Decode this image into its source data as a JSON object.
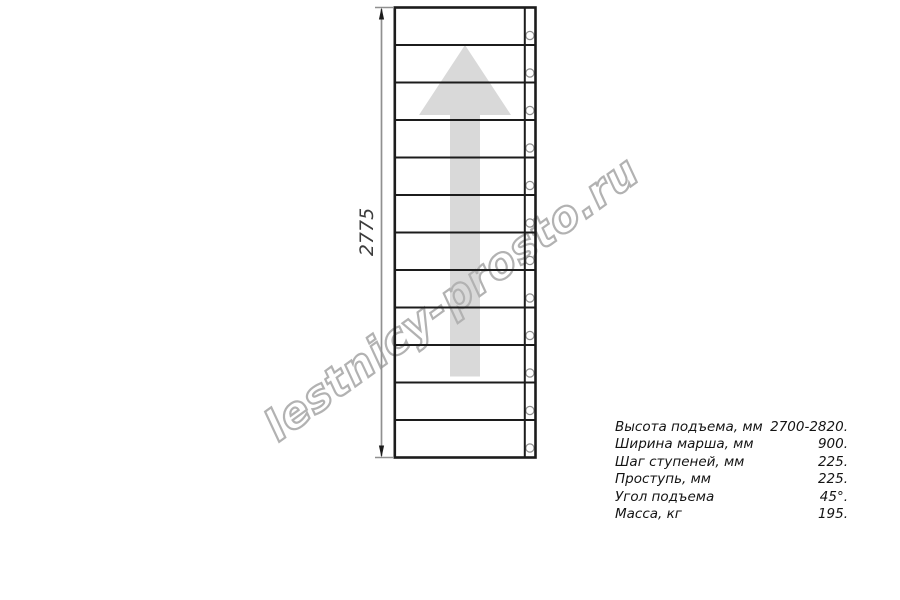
{
  "drawing": {
    "type": "staircase-plan-top-view",
    "dimension_label": "2775",
    "steps_count": 12,
    "watermark_text": "lestnicy-prosto.ru",
    "colors": {
      "line": "#1c1c1c",
      "dimension_line": "#909090",
      "arrow_fill": "#d9d9d9",
      "watermark": "#b2b2b2",
      "bolt_stroke": "#8f8f8f"
    }
  },
  "specs": {
    "rows": [
      {
        "label": "Высота подъема, мм",
        "value": "2700-2820."
      },
      {
        "label": "Ширина марша, мм",
        "value": "900."
      },
      {
        "label": "Шаг ступеней, мм",
        "value": "225."
      },
      {
        "label": "Проступь, мм",
        "value": "225."
      },
      {
        "label": "Угол подъема",
        "value": "45°."
      },
      {
        "label": "Масса, кг",
        "value": "195."
      }
    ]
  }
}
